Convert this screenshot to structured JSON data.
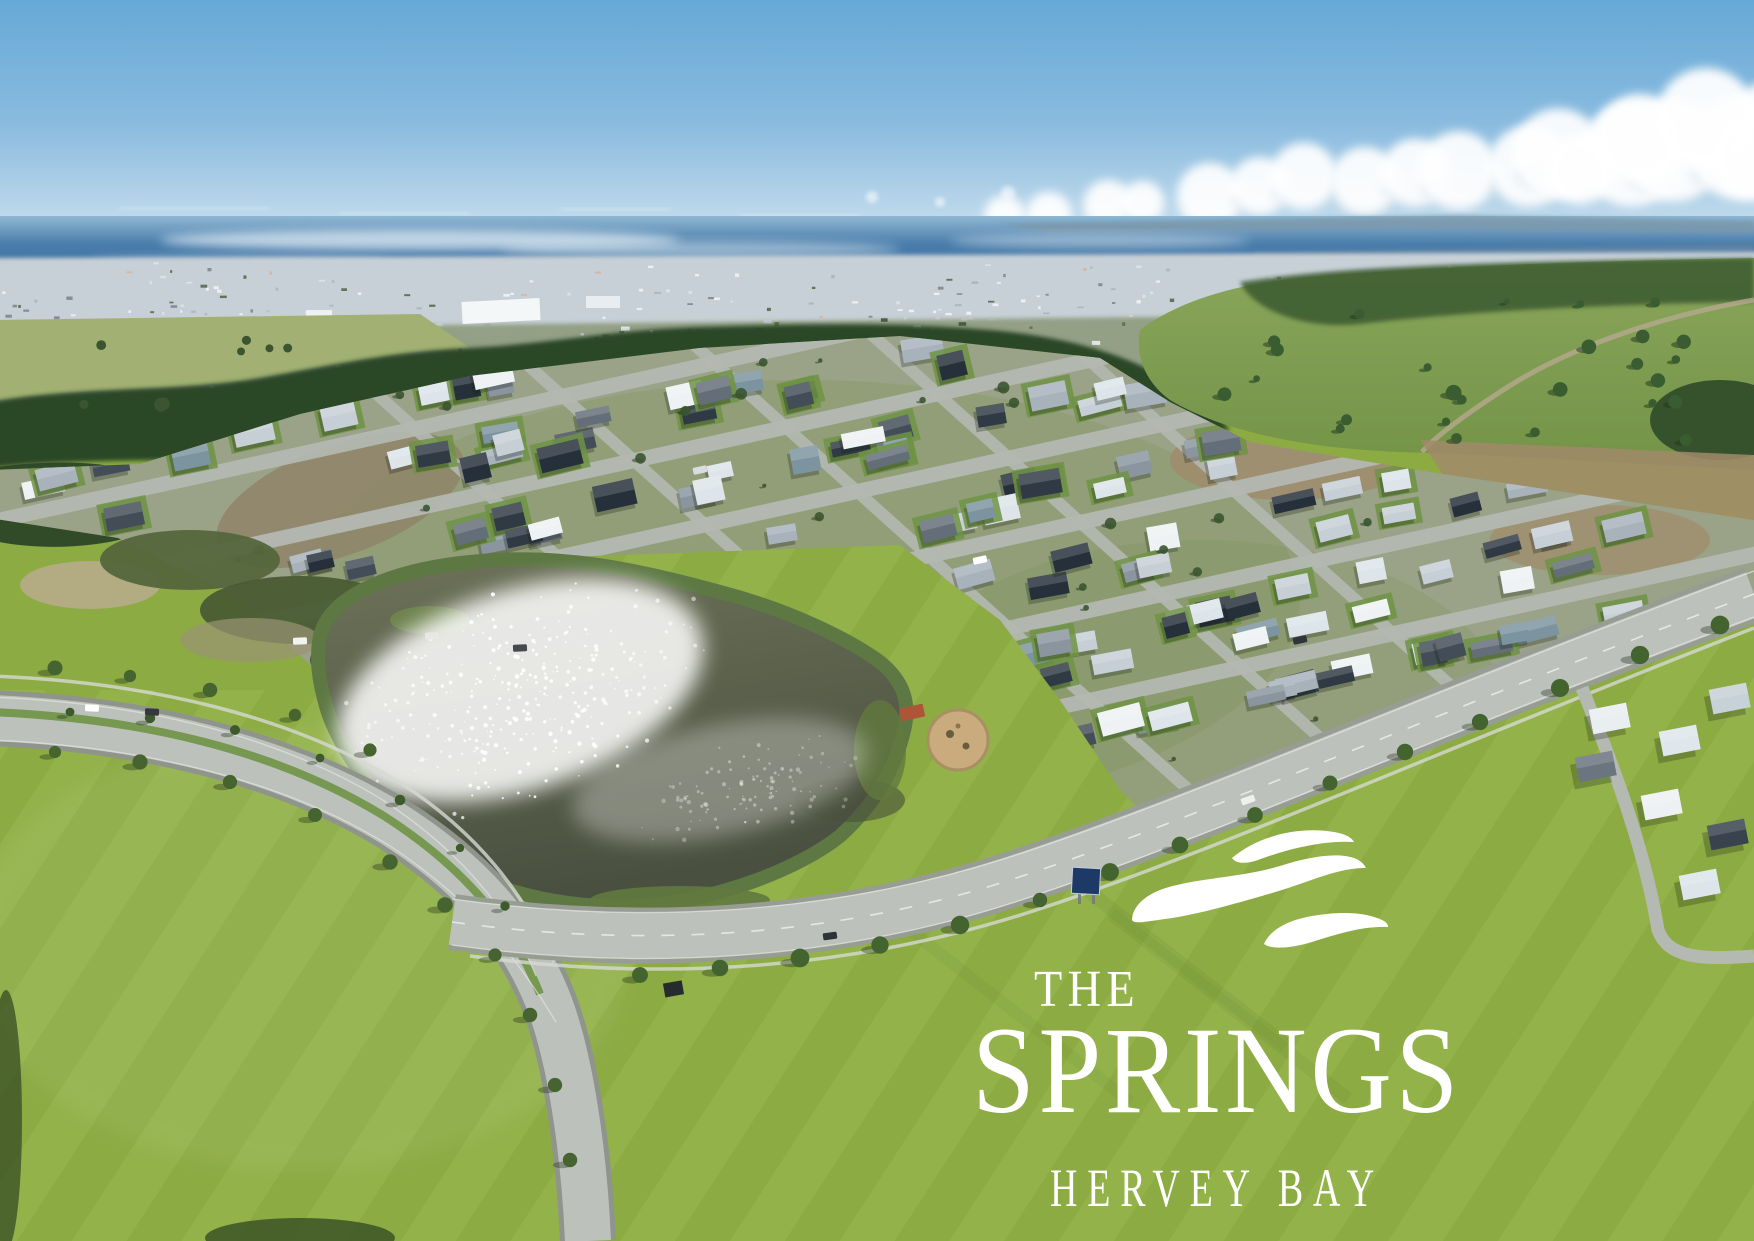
{
  "image_type": "aerial-photograph-marketing-image",
  "logo": {
    "the": "THE",
    "name": "SPRINGS",
    "location": "HERVEY BAY",
    "icon": "triple-wave-icon",
    "color": "#ffffff"
  },
  "scene": {
    "seed": 7,
    "palette": {
      "logo_white": "#ffffff",
      "sky_top": "#66a9d7",
      "sky_mid": "#8abbdf",
      "sky_horizon": "#dfecf5",
      "cloud": "#ffffff",
      "cloud_shadow": "#c9d8e4",
      "ocean_far": "#8fb7d2",
      "ocean_deep": "#4a7dab",
      "ocean_near": "#3a6fa0",
      "headland": "#7c97a8",
      "city_haze": "#c7d0d7",
      "suburb_band": "#93a086",
      "fields": "#a2b173",
      "tree_dark": "#2c4627",
      "tree_mid": "#3e5c32",
      "hill_top": "#8aa65b",
      "hill_bottom": "#739347",
      "estate_base": "#9aa287",
      "street": "#b4b9b2",
      "road": "#bdc1bc",
      "road_casing": "#8f958c",
      "road_line": "#eceee9",
      "footpath": "#d6d9d2",
      "lawn": "#6e9344",
      "grass": "#8cab43",
      "grass_light": "#93b24a",
      "water_top": "#6d7258",
      "water_deep": "#4a5040",
      "bank": "#5e7844",
      "sand": "#c9ab7e",
      "dirt": "#9b8466",
      "sign_navy": "#1d3a66"
    },
    "roof_colors": [
      "#eef2f4",
      "#dde5ea",
      "#c6cfd6",
      "#a7b2bb",
      "#8a959f",
      "#636e78",
      "#434d57",
      "#303a44",
      "#26303a",
      "#7c94a0"
    ],
    "counts": {
      "houses": 170,
      "estate_trees": 40,
      "hill_trees": 26,
      "lake_sparkle_dots": 320,
      "lake_sparkle_dots_east": 110,
      "city_flecks": 240,
      "suburb_flecks": 150,
      "cloud_puffs": 16
    }
  }
}
